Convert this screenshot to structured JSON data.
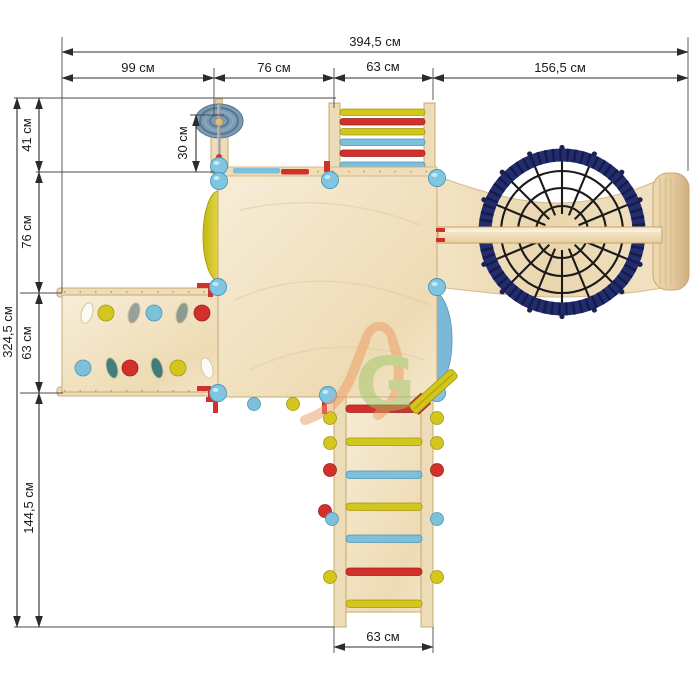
{
  "dimensions": {
    "unit": "см",
    "top_total": "394,5 см",
    "top_segments": [
      "99 см",
      "76 см",
      "63 см",
      "156,5 см"
    ],
    "left_total": "324,5 см",
    "left_segments": [
      "41 см",
      "76 см",
      "63 см",
      "144,5 см"
    ],
    "wheel_offset": "30 см",
    "ladder_width_bottom": "63 см"
  },
  "watermark": {
    "letter": "G"
  },
  "colors": {
    "red": "#d2302a",
    "yellow": "#d3c71e",
    "light_blue": "#7cc0da",
    "cap_blue": "#7fc6e2",
    "navy_ring": "#232c6e",
    "navy_dark": "#141c4a",
    "net_line": "#1a1a1a",
    "wheel_blue": "#7b9ab4",
    "wood_light": "#f6ecd4",
    "wood_mid": "#eedcb6",
    "wood_edge": "#c9a870",
    "slide_yellow": "#d2c72e",
    "slide_blue": "#7cb8d8",
    "watermark_orange": "#ed9a62",
    "watermark_green": "#9fc769"
  },
  "parts": {
    "monkey_bar_rungs": [
      "yellow",
      "red",
      "yellow",
      "light_blue",
      "red",
      "light_blue"
    ],
    "ladder_rungs": [
      "red",
      "yellow",
      "light_blue",
      "yellow",
      "light_blue",
      "red",
      "yellow"
    ],
    "ladder_knobs_left": [
      "yellow",
      "yellow",
      "red",
      "red",
      "light_blue",
      "yellow"
    ],
    "ladder_knobs_right": [
      "yellow",
      "yellow",
      "red",
      "light_blue",
      "yellow"
    ],
    "platform_knobs": [
      "light_blue",
      "yellow"
    ],
    "railing_segments": [
      "light_blue",
      "red"
    ],
    "ramp_row_top": [
      "hole",
      "yellow",
      "hole",
      "light_blue",
      "hole",
      "red"
    ],
    "ramp_row_bottom": [
      "light_blue",
      "hole",
      "red",
      "hole",
      "yellow",
      "hole"
    ]
  }
}
